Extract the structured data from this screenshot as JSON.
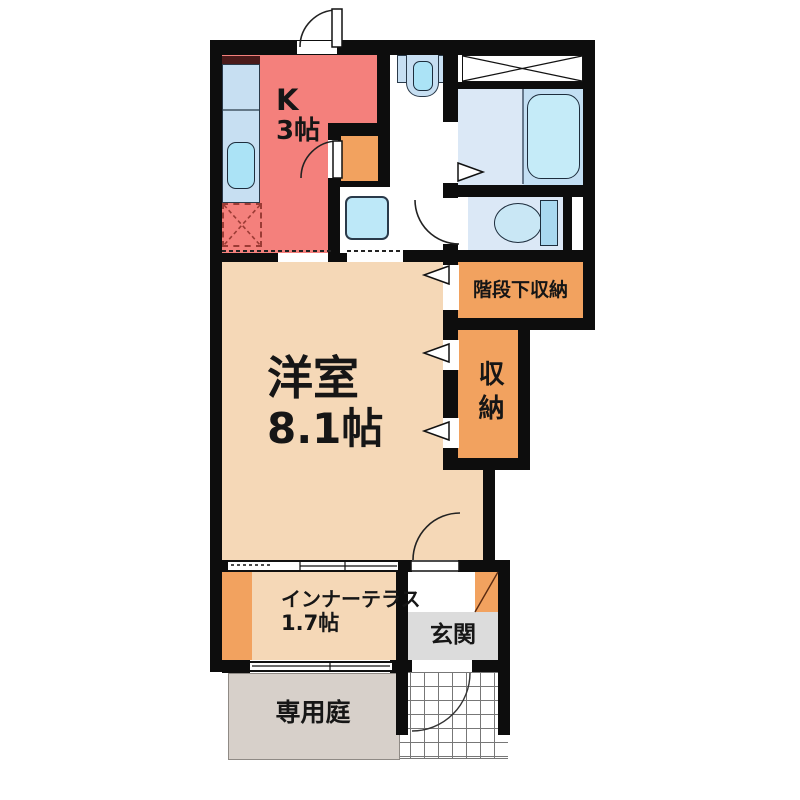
{
  "plan": {
    "type": "apartment-floor-plan",
    "rooms": {
      "kitchen": {
        "label_line1": "K",
        "label_line2": "3帖",
        "color": "#F4807C"
      },
      "western_room": {
        "label_line1": "洋室",
        "label_line2": "8.1帖",
        "color": "#F5D8B7"
      },
      "inner_terrace": {
        "label_line1": "インナーテラス",
        "label_line2": "1.7帖",
        "color": "#F5D8B7",
        "accent_color": "#F2A25F"
      },
      "under_stairs_storage": {
        "label": "階段下収納",
        "color": "#F2A25F"
      },
      "storage": {
        "label": "収納",
        "color": "#F2A25F"
      },
      "entrance": {
        "label": "玄関",
        "color": "#DCDCDC",
        "accent_color": "#F2A25F"
      },
      "private_garden": {
        "label": "専用庭",
        "color": "#D7D0CA"
      },
      "bathroom": {
        "floor_color": "#DBE8F6",
        "tub_area_color": "#C3DFF3"
      },
      "toilet": {
        "floor_color": "#DBE8F6"
      }
    },
    "fixtures": [
      "kitchen-counter",
      "kitchen-sink",
      "refrigerator-space",
      "range-hood",
      "wash-basin",
      "washing-machine-space",
      "bathtub",
      "toilet",
      "storage-niche",
      "shoe-step",
      "tile-porch",
      "entry-door"
    ],
    "colors": {
      "wall": "#0d0d0d",
      "water_fixture_fill": "#C7DFF2",
      "fixture_cyan": "#ABE3F6",
      "tub_fill": "#C5EBF8",
      "dashed_appliance_outline": "#9B3B35"
    }
  }
}
